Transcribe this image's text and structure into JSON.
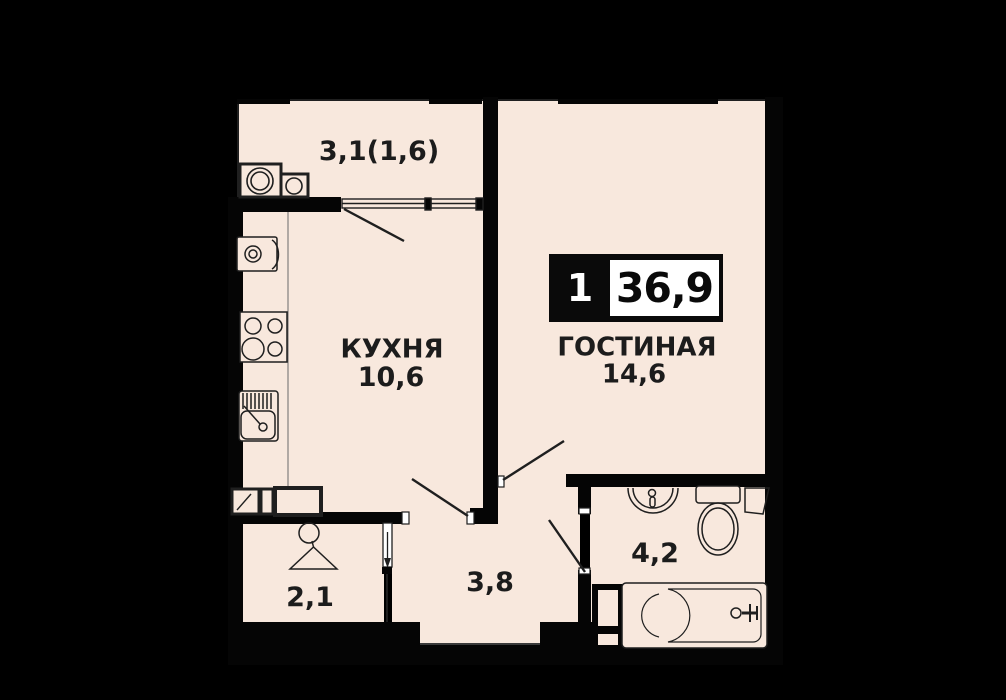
{
  "floorplan": {
    "badge": {
      "room_count": "1",
      "total_area": "36,9"
    },
    "rooms": {
      "balcony": {
        "area_label": "3,1(1,6)"
      },
      "kitchen": {
        "name": "КУХНЯ",
        "area": "10,6"
      },
      "living_room": {
        "name": "ГОСТИНАЯ",
        "area": "14,6"
      },
      "wardrobe": {
        "area": "2,1"
      },
      "hallway": {
        "area": "3,8"
      },
      "bathroom": {
        "area": "4,2"
      }
    },
    "colors": {
      "floor": "#f8e8dd",
      "wall": "#000000",
      "line": "#1f1f1f",
      "badge_bg": "#0a0a0a",
      "badge_panel": "#ffffff"
    },
    "icons": [
      "washing-machine-icon",
      "dryer-icon",
      "fridge-icon",
      "stove-icon",
      "kitchen-sink-icon",
      "vent-shaft-icon",
      "hanger-icon",
      "wash-basin-icon",
      "toilet-icon",
      "corner-shelf-icon",
      "bathtub-icon",
      "window-icon",
      "door-leaf-icon",
      "sliding-door-icon"
    ]
  }
}
